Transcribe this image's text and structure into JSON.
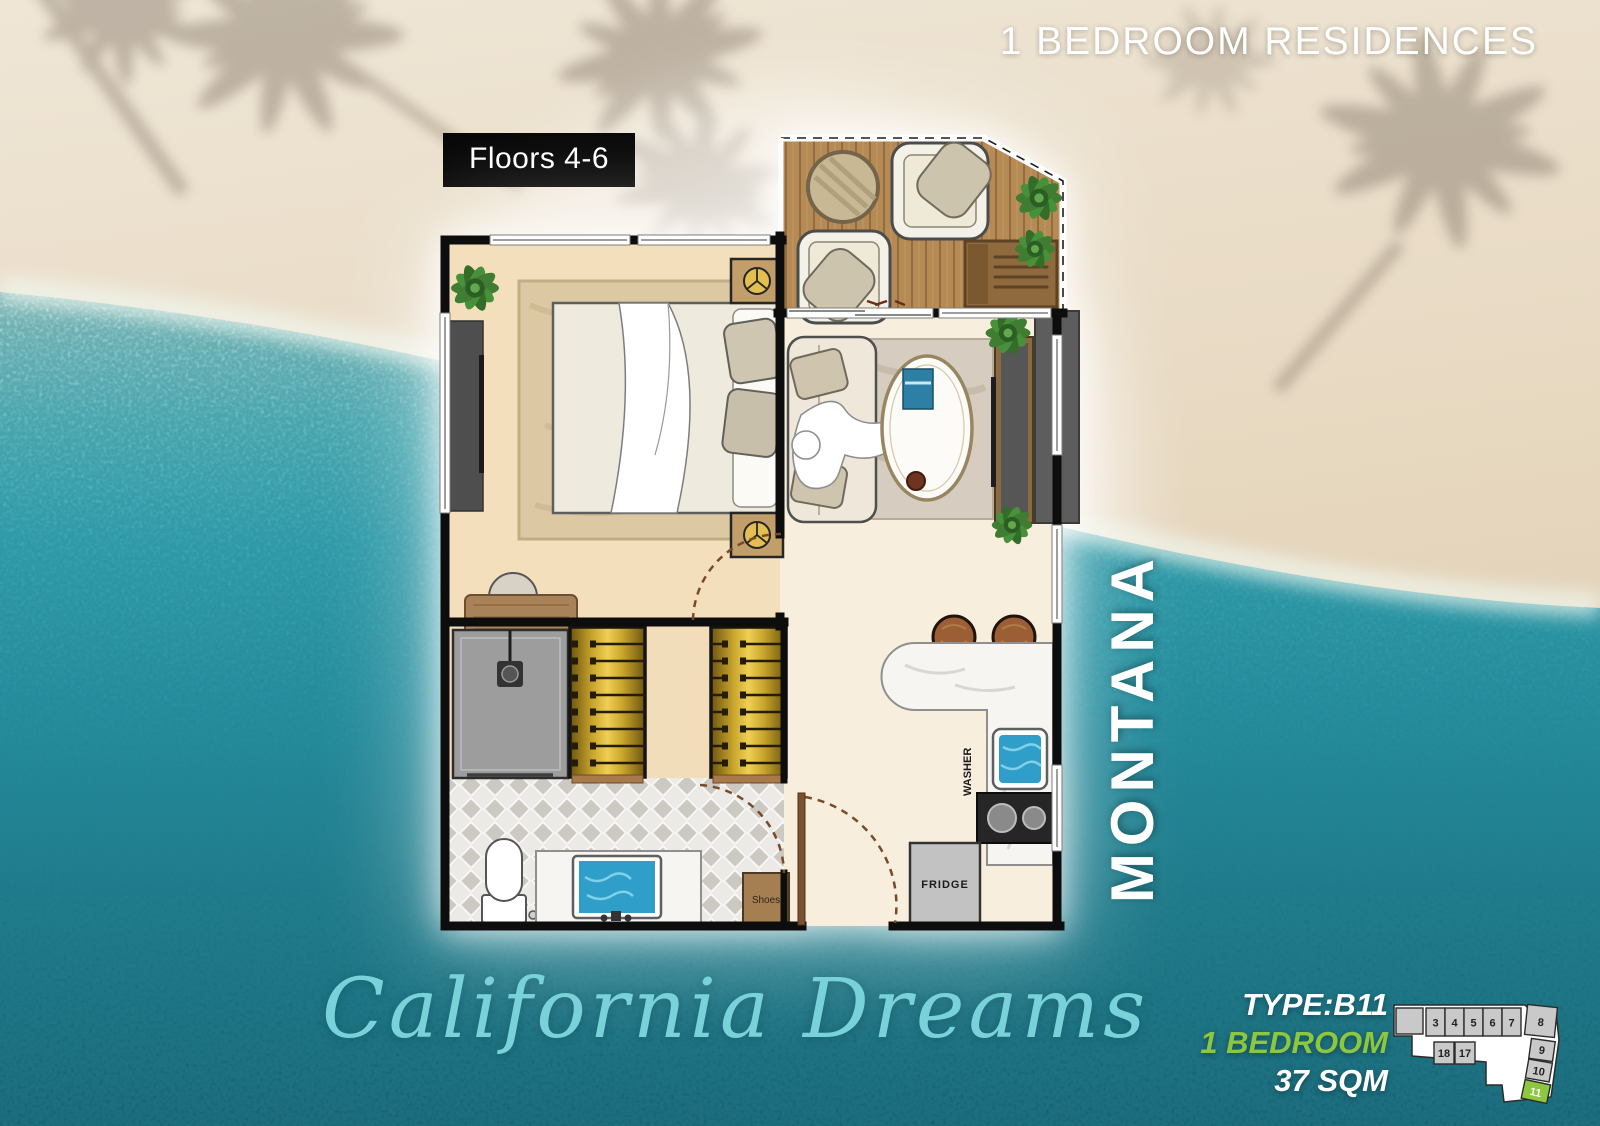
{
  "header": {
    "title": "1 BEDROOM RESIDENCES"
  },
  "floor_plan": {
    "floors_badge": "Floors 4-6",
    "labels": {
      "washer": "WASHER",
      "fridge": "FRIDGE",
      "shoes": "Shoes"
    }
  },
  "residence_name": "MONTANA",
  "brand_script": "California Dreams",
  "unit_details": {
    "type": "TYPE:B11",
    "bedrooms": "1 BEDROOM",
    "area": "37 SQM"
  },
  "unit_map": {
    "labels": [
      "3",
      "4",
      "5",
      "6",
      "7",
      "8",
      "18",
      "17",
      "9",
      "10",
      "11"
    ],
    "highlighted_unit": "11"
  },
  "colors": {
    "accent_green": "#8dc63f",
    "script_teal": "#79d2da",
    "badge_bg": "#050505",
    "water_deep": "#135b6d",
    "sand": "#e7dac4",
    "wardrobe_gold": "#d8b23a",
    "deck_wood": "#b58a55"
  }
}
